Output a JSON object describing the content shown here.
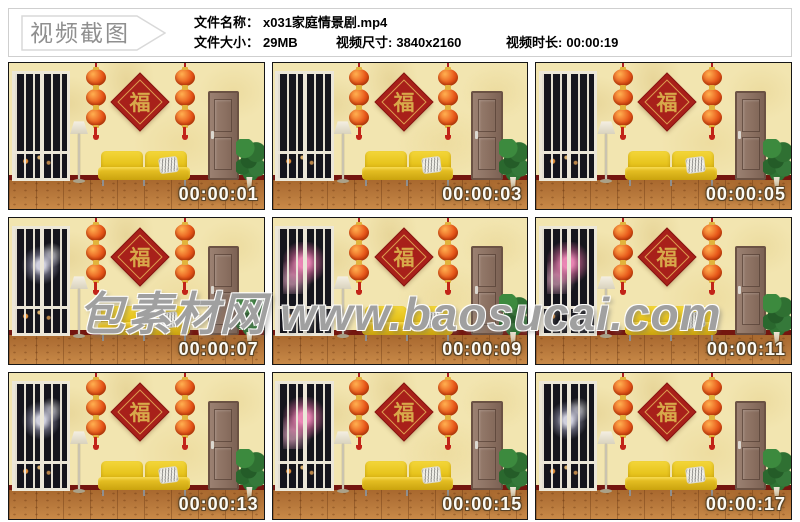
{
  "header": {
    "badge": "视频截图",
    "file_name_label": "文件名称：",
    "file_name": "x031家庭情景剧.mp4",
    "file_size_label": "文件大小：",
    "file_size": "29MB",
    "dimensions_label": "视频尺寸:",
    "dimensions": "3840x2160",
    "duration_label": "视频时长:",
    "duration": "00:00:19"
  },
  "watermark": "包素材网 www.baosucai.com",
  "scene": {
    "fu_character": "福",
    "colors": {
      "wall": "#f2e5b0",
      "floor": "#b5763a",
      "baseboard": "#74160f",
      "sofa": "#e8c51e",
      "door": "#8a6f60",
      "lantern": "#e8581a",
      "fu_banner": "#a8201a",
      "fu_text": "#d8a84a"
    }
  },
  "frames": [
    {
      "timestamp": "00:00:01",
      "fireworks": "none"
    },
    {
      "timestamp": "00:00:03",
      "fireworks": "none"
    },
    {
      "timestamp": "00:00:05",
      "fireworks": "none"
    },
    {
      "timestamp": "00:00:07",
      "fireworks": "white"
    },
    {
      "timestamp": "00:00:09",
      "fireworks": "pink"
    },
    {
      "timestamp": "00:00:11",
      "fireworks": "pink"
    },
    {
      "timestamp": "00:00:13",
      "fireworks": "white"
    },
    {
      "timestamp": "00:00:15",
      "fireworks": "pink"
    },
    {
      "timestamp": "00:00:17",
      "fireworks": "white"
    }
  ]
}
